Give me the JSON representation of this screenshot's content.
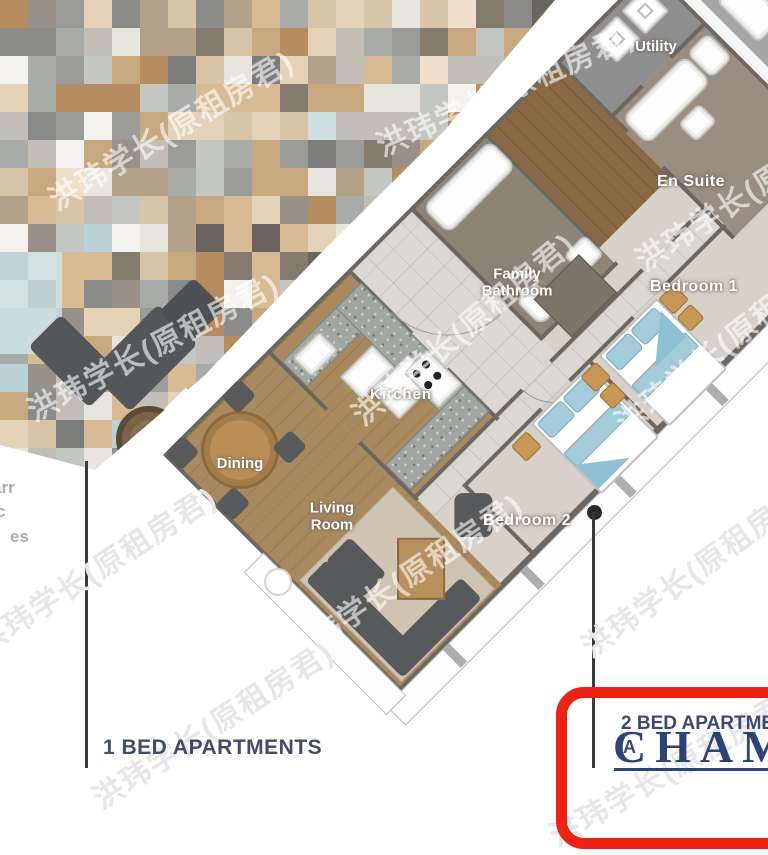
{
  "plan": {
    "rooms": {
      "utility": "Utility",
      "en_suite": "En Suite",
      "family_1": "Family",
      "family_2": "Bathroom",
      "bedroom1": "Bedroom 1",
      "bedroom2": "Bedroom 2",
      "kitchen": "Kitchen",
      "dining": "Dining",
      "living_1": "Living",
      "living_2": "Room"
    }
  },
  "captions": {
    "one_bed": "1 BED APARTMENTS",
    "two_bed": "2 BED APARTMENTS",
    "two_bed_sub": "A",
    "brand_overlay": "CHAMP"
  },
  "edge_fragments": {
    "f1": "arr",
    "f2": "c",
    "f3": "es"
  },
  "watermark": {
    "text": "洪玮学长(原租房君)",
    "color_on_plan": "rgba(255,255,255,0.6)",
    "color_on_white": "#e7e7ea",
    "instances": [
      {
        "x": 170,
        "y": 128,
        "a": -31,
        "white": false
      },
      {
        "x": 505,
        "y": 88,
        "a": -24,
        "white": false
      },
      {
        "x": 755,
        "y": 185,
        "a": -33,
        "white": false
      },
      {
        "x": 152,
        "y": 345,
        "a": -28,
        "white": false
      },
      {
        "x": 462,
        "y": 327,
        "a": -40,
        "white": false
      },
      {
        "x": 95,
        "y": 568,
        "a": -33,
        "white": true
      },
      {
        "x": 402,
        "y": 577,
        "a": -34,
        "white": false
      },
      {
        "x": 212,
        "y": 723,
        "a": -33,
        "white": true
      },
      {
        "x": 697,
        "y": 566,
        "a": -36,
        "white": true
      },
      {
        "x": 728,
        "y": 338,
        "a": -38,
        "white": false
      },
      {
        "x": 672,
        "y": 766,
        "a": -30,
        "white": true
      }
    ]
  },
  "colors": {
    "accent_red": "#ee2115",
    "caption_navy": "#414d66",
    "brand_navy": "#2d4472",
    "wall": "#6e675f",
    "wood": "#a98a60",
    "wood_dark": "#8b6844",
    "carpet": "#d8d1c9",
    "corridor_tile": "#dbd8d3",
    "bath_floor": "#8e8377",
    "ensuite_floor": "#998e81",
    "utility_floor": "#8f8f8f",
    "granite": "#a2a6a3",
    "bed_blue": "#a3cbda",
    "nightstand_tan": "#c79756"
  },
  "mosaic": {
    "tile_px": 28,
    "palette": [
      [
        "#c8a87e",
        3
      ],
      [
        "#d7bb95",
        3
      ],
      [
        "#b68c60",
        2
      ],
      [
        "#d9c4a8",
        2
      ],
      [
        "#e4d2b8",
        1.5
      ],
      [
        "#b3a18a",
        1.5
      ],
      [
        "#a8aba8",
        2
      ],
      [
        "#9b9b98",
        2
      ],
      [
        "#8b8b89",
        1.5
      ],
      [
        "#c2bdb6",
        2
      ],
      [
        "#e8e4de",
        2
      ],
      [
        "#f4f2ef",
        2
      ],
      [
        "#7c7c7a",
        1
      ],
      [
        "#cfdfe2",
        0.8
      ],
      [
        "#b9d2d6",
        0.5
      ],
      [
        "#6a655e",
        0.8
      ],
      [
        "#999089",
        1
      ],
      [
        "#c4c6c2",
        1.5
      ],
      [
        "#847b6e",
        0.7
      ],
      [
        "#efe0cc",
        1
      ]
    ]
  }
}
